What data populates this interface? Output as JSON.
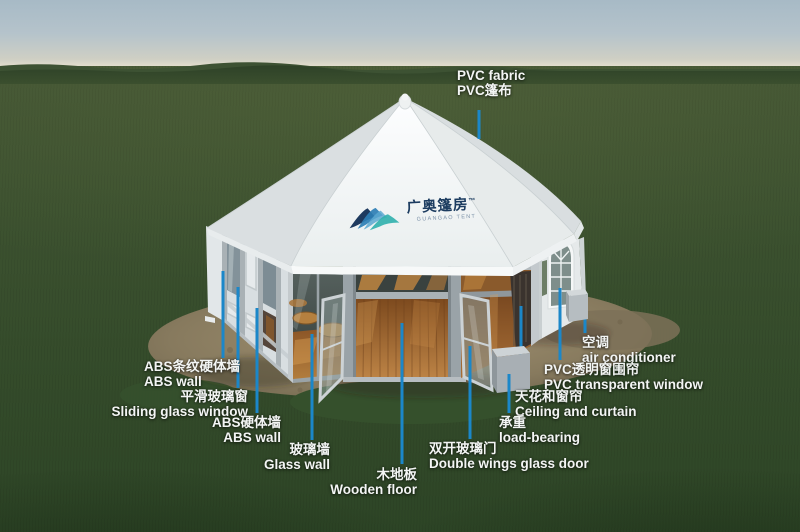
{
  "logo": {
    "name_zh": "广奥篷房",
    "trademark": "™",
    "name_en": "GUANGAO TENT"
  },
  "annotations": [
    {
      "id": "pvc-fabric",
      "line1": "PVC fabric",
      "line2": "PVC篷布"
    },
    {
      "id": "abs-striped-wall",
      "line1": "ABS条纹硬体墙",
      "line2": "ABS wall"
    },
    {
      "id": "sliding-glass-window",
      "line1": "平滑玻璃窗",
      "line2": "Sliding glass window"
    },
    {
      "id": "abs-wall",
      "line1": "ABS硬体墙",
      "line2": "ABS wall"
    },
    {
      "id": "glass-wall",
      "line1": "玻璃墙",
      "line2": "Glass wall"
    },
    {
      "id": "wooden-floor",
      "line1": "木地板",
      "line2": "Wooden floor"
    },
    {
      "id": "double-wings-glass-door",
      "line1": "双开玻璃门",
      "line2": "Double wings glass door"
    },
    {
      "id": "air-conditioner",
      "line1": "空调",
      "line2": "air conditioner"
    },
    {
      "id": "pvc-transparent-window",
      "line1": "PVC透明窗围帘",
      "line2": "PVC transparent window"
    },
    {
      "id": "ceiling-and-curtain",
      "line1": "天花和窗帘",
      "line2": "Ceiling and curtain"
    },
    {
      "id": "load-bearing",
      "line1": "承重",
      "line2": "load-bearing"
    }
  ],
  "icons": {
    "brand_mark": "mountain-swoosh"
  },
  "colors": {
    "leader_line": "#1b87c9",
    "label_text": "#f3f5f4",
    "logo_navy": "#1c3c60",
    "logo_blue": "#3e9ec9",
    "logo_teal": "#2fb0ad",
    "roof_white": "#f4f6f6",
    "wood_floor": "#a06a32",
    "dirt": "#8d7d60",
    "grass_dark": "#31452a",
    "sky_top": "#a7bac6"
  }
}
